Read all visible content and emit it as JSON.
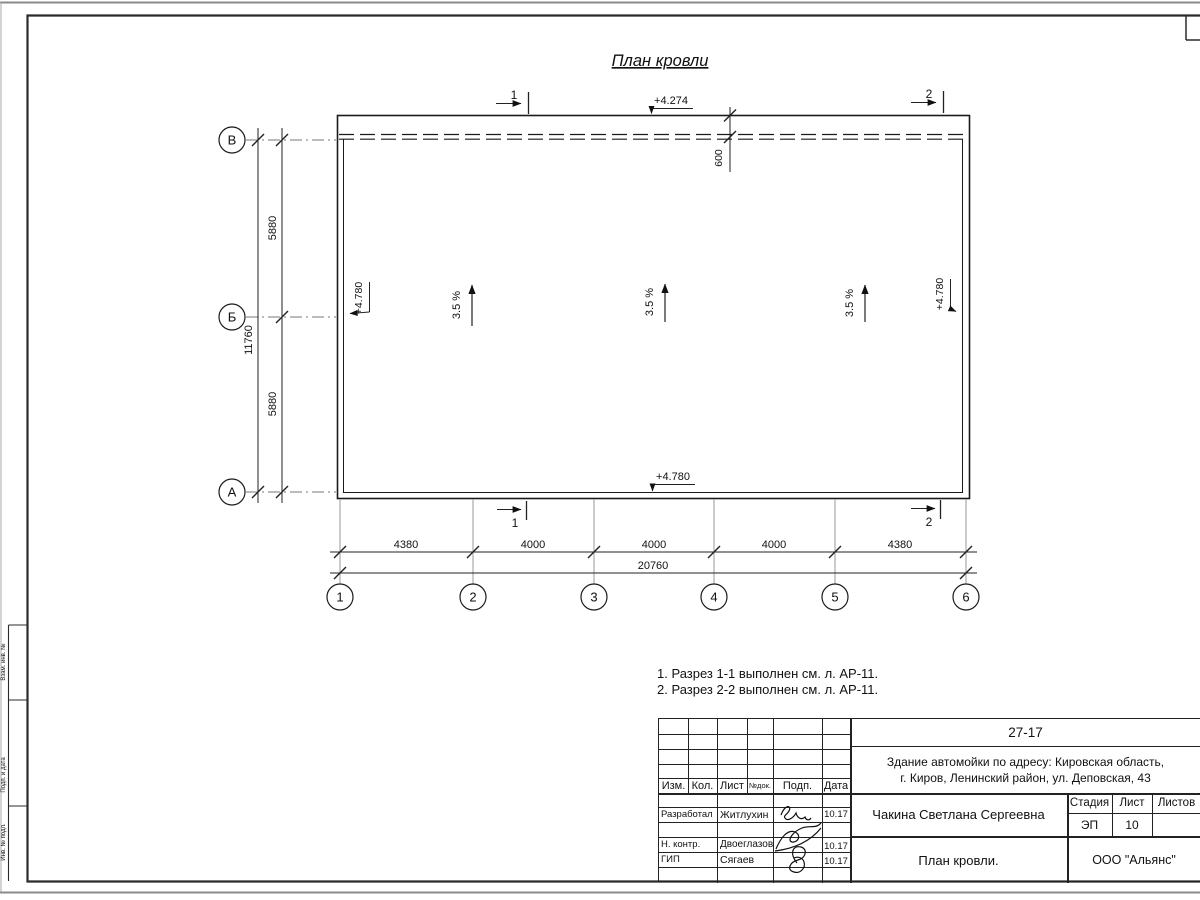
{
  "title": "План кровли",
  "plan": {
    "slope": "3.5 %",
    "elev_canopy": "+4.274",
    "elev_roof": "+4.780",
    "canopy_depth": "600"
  },
  "sections": {
    "s1": "1",
    "s2": "2"
  },
  "axes": {
    "horizontal": [
      "В",
      "Б",
      "А"
    ],
    "vertical": [
      "1",
      "2",
      "3",
      "4",
      "5",
      "6"
    ]
  },
  "dimensions": {
    "left_row": [
      "5880",
      "5880"
    ],
    "left_total": "11760",
    "bottom_row": [
      "4380",
      "4000",
      "4000",
      "4000",
      "4380"
    ],
    "bottom_total": "20760"
  },
  "notes": [
    "1. Разрез 1-1 выполнен см. л. АР-11.",
    "2. Разрез 2-2 выполнен см. л. АР-11."
  ],
  "margin_labels": [
    "Взам. инв. №",
    "Подп. и дата",
    "Инв. № подл."
  ],
  "title_block": {
    "code": "27-17",
    "address_line1": "Здание автомойки по адресу: Кировская область,",
    "address_line2": "г. Киров, Ленинский район, ул. Деповская, 43",
    "header_cols": [
      "Изм.",
      "Кол.",
      "Лист",
      "№док.",
      "Подп.",
      "Дата"
    ],
    "rows": [
      {
        "role": "Разработал",
        "name": "Житлухин",
        "date": "10.17"
      },
      {
        "role": "Н. контр.",
        "name": "Двоеглазов",
        "date": "10.17"
      },
      {
        "role": "ГИП",
        "name": "Сягаев",
        "date": "10.17"
      }
    ],
    "client": "Чакина Светлана Сергеевна",
    "stage_label": "Стадия",
    "sheet_label": "Лист",
    "sheets_label": "Листов",
    "stage": "ЭП",
    "sheet": "10",
    "drawing_name": "План кровли.",
    "company": "ООО \"Альянс\""
  },
  "colors": {
    "ink": "#1a1a1a",
    "paper": "#ffffff",
    "aux_line": "#999999"
  }
}
